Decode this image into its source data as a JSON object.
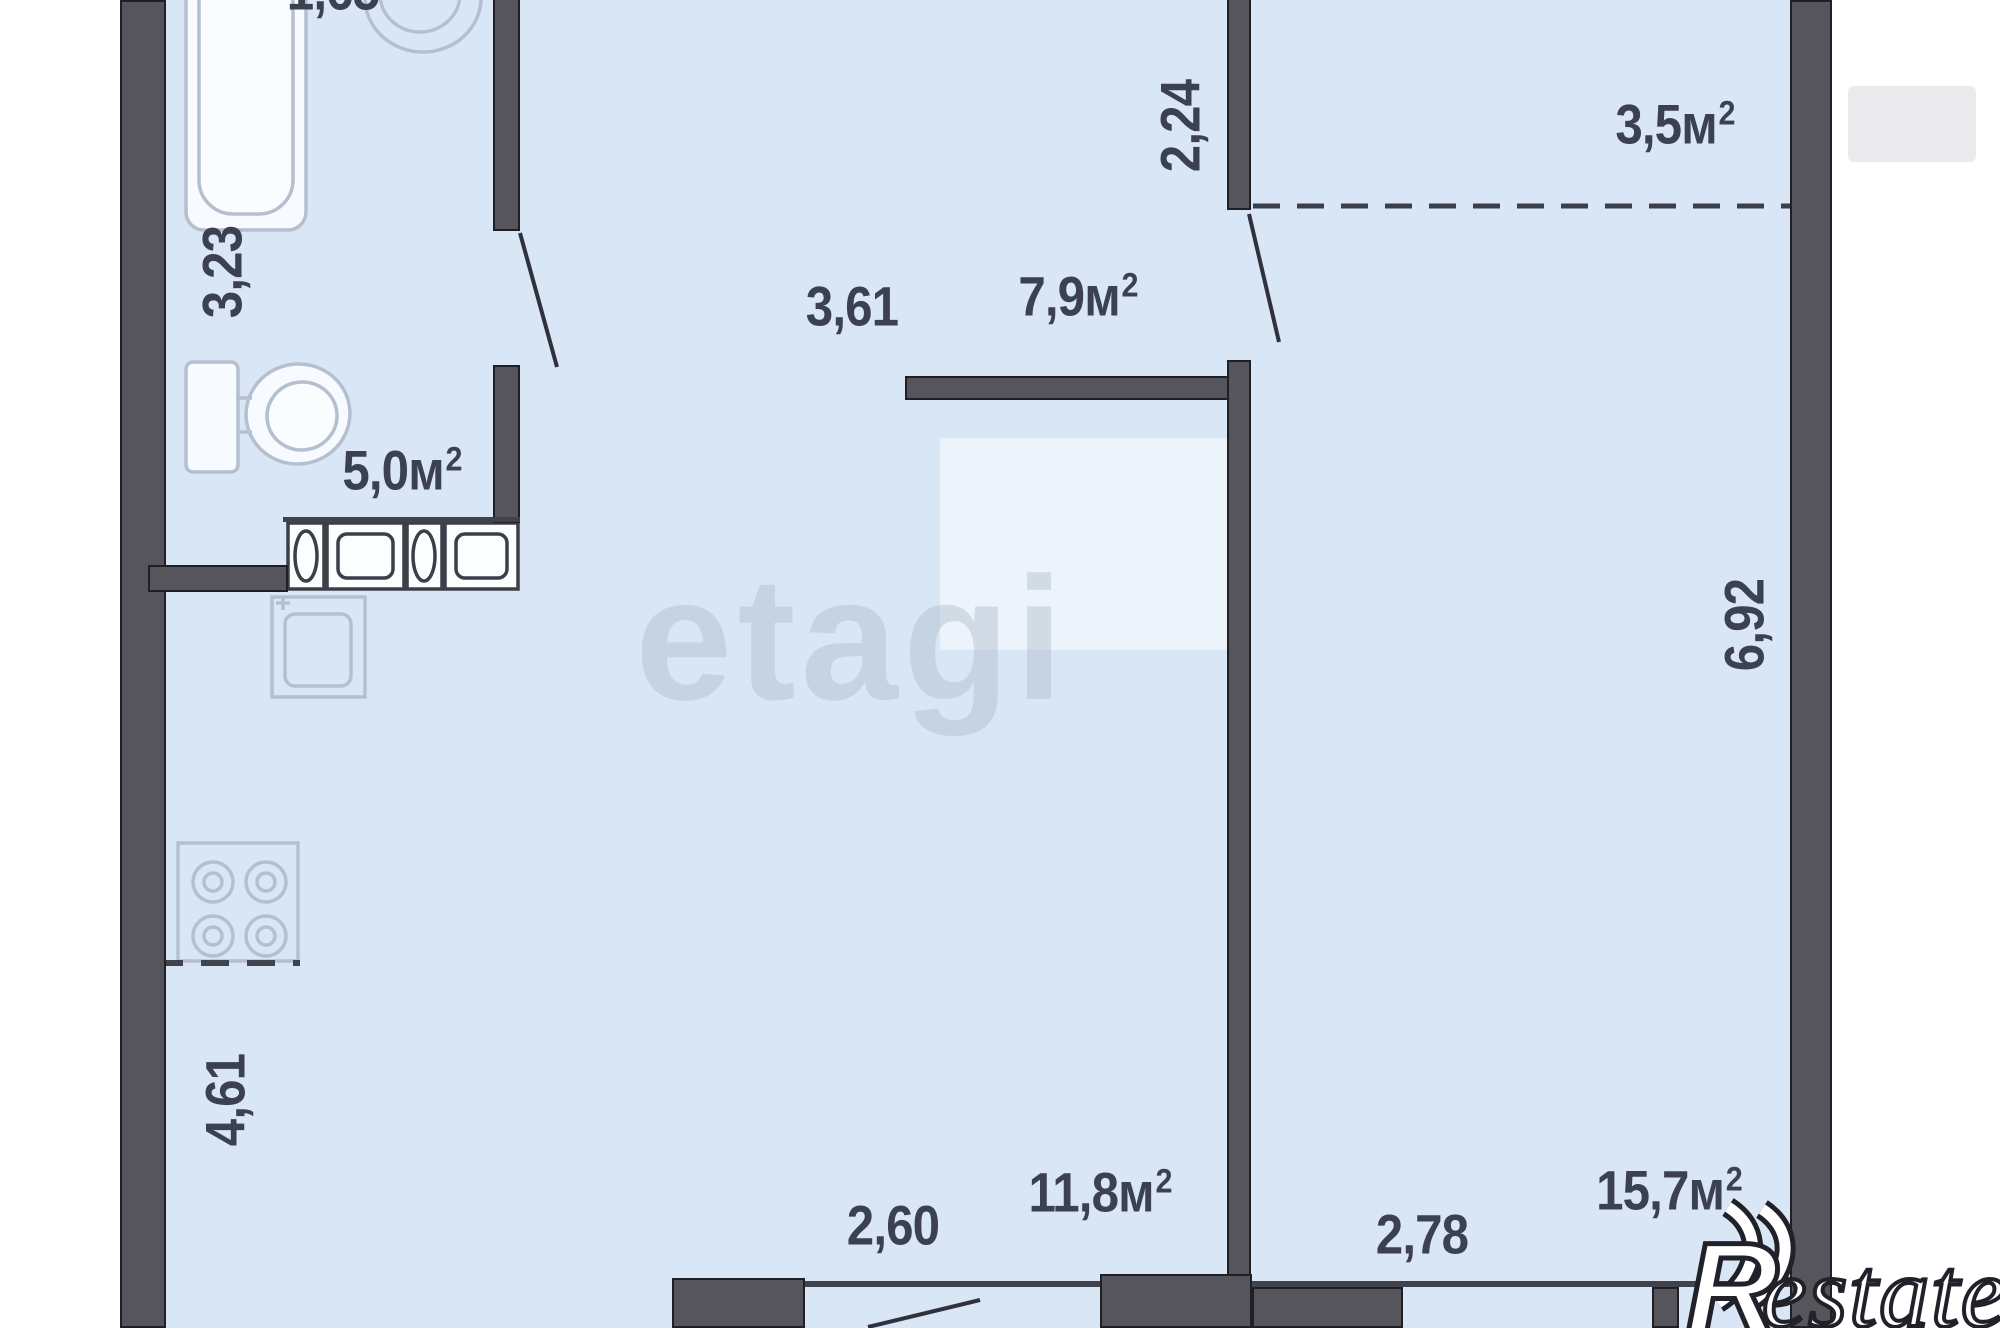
{
  "plan": {
    "type": "apartment-floor-plan",
    "dimensions": {
      "bath_width_top": "1,65",
      "bath_height": "3,23",
      "niche_depth": "2,24",
      "hall_width": "3,61",
      "right_room_height": "6,92",
      "kitchen_height": "4,61",
      "kitchen_width": "2,60",
      "right_room_width": "2,78"
    },
    "areas": {
      "bathroom": {
        "value": "5,0м",
        "sup": "2"
      },
      "hallway": {
        "value": "7,9м",
        "sup": "2"
      },
      "niche": {
        "value": "3,5м",
        "sup": "2"
      },
      "kitchen_living": {
        "value": "11,8м",
        "sup": "2"
      },
      "right_room": {
        "value": "15,7м",
        "sup": "2"
      }
    },
    "fixtures": [
      "bathtub",
      "washbasin",
      "toilet",
      "washing-machine",
      "washing-machine",
      "kitchen-sink",
      "stove-cooktop"
    ],
    "watermarks": {
      "center": "etagi",
      "corner_initial": "R",
      "corner_rest": "estate"
    },
    "colors": {
      "floor": "#d9e6f6",
      "wall": "#55555b",
      "wall_edge": "#1f1f25",
      "dim_text": "#3b4150",
      "fixture_outline": "#b4c0cf",
      "line": "#41434c",
      "margin": "#ffffff"
    }
  }
}
